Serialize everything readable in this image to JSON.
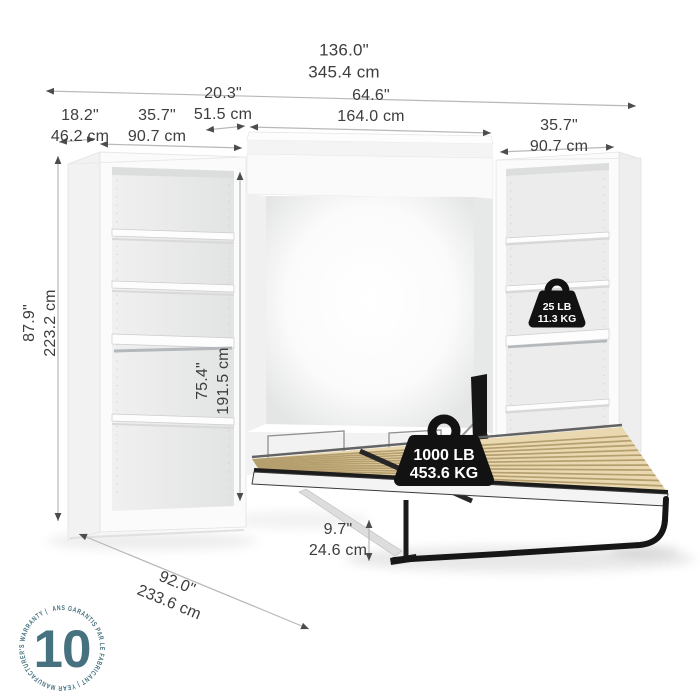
{
  "dimensions": {
    "total_width": {
      "inches": "136.0\"",
      "cm": "345.4 cm"
    },
    "side_depth": {
      "inches": "18.2\"",
      "cm": "46.2 cm"
    },
    "left_shelf_width": {
      "inches": "35.7\"",
      "cm": "90.7 cm"
    },
    "bed_depth_closed": {
      "inches": "20.3\"",
      "cm": "51.5 cm"
    },
    "bed_cabinet_width": {
      "inches": "64.6\"",
      "cm": "164.0 cm"
    },
    "right_shelf_width": {
      "inches": "35.7\"",
      "cm": "90.7 cm"
    },
    "total_height": {
      "inches": "87.9\"",
      "cm": "223.2 cm"
    },
    "shelf_interior_height": {
      "inches": "75.4\"",
      "cm": "191.5 cm"
    },
    "bed_frame_height": {
      "inches": "9.7\"",
      "cm": "24.6 cm"
    },
    "bed_open_depth": {
      "inches": "92.0\"",
      "cm": "233.6 cm"
    }
  },
  "capacity_badges": {
    "shelf": {
      "lb": "25 LB",
      "kg": "11.3 KG"
    },
    "bed": {
      "lb": "1000 LB",
      "kg": "453.6 KG"
    }
  },
  "warranty_badge": {
    "years": "10",
    "ring_text": "ANS GARANTIS PAR LE FABRICANT  |  YEAR MANUFACTURER'S WARRANTY  |",
    "color": "#46717f"
  },
  "colors": {
    "background": "#ffffff",
    "dimension_text": "#3d3d3d",
    "dimension_line": "#b8b8b8",
    "arrowhead": "#4c4c4c",
    "badge_black": "#121212",
    "badge_text": "#ffffff",
    "warranty_teal": "#46717f",
    "slat_wood": "#e9d8b0",
    "furniture_white": "#fafafa",
    "interior_gray": "#eaeaea"
  }
}
